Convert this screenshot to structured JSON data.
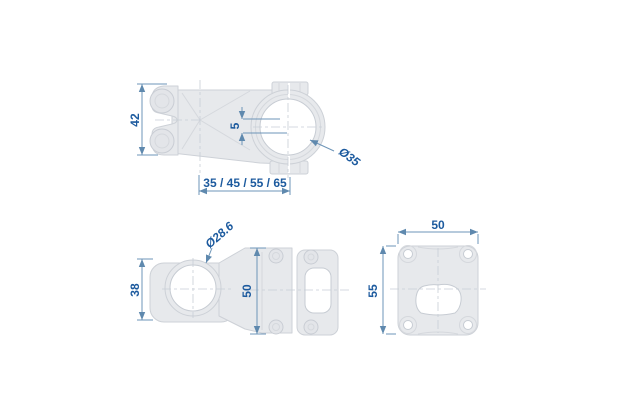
{
  "drawing": {
    "title": "stem-technical-drawing",
    "background": "#ffffff",
    "colors": {
      "part_fill": "#e7e9ec",
      "part_outline": "#cdd1d7",
      "detail_line": "#d5d8dd",
      "centerline": "#c8ced6",
      "dimension_line": "#6e95b8",
      "dimension_text": "#1c5a9e",
      "hole_fill": "#ffffff"
    },
    "views": {
      "top": {
        "label": "top view",
        "dims": {
          "height": "42",
          "rise": "5",
          "bar_clamp_diameter": "Ø35",
          "length_options": "35 / 45 / 55 / 65"
        }
      },
      "side": {
        "label": "side view",
        "dims": {
          "steerer_diameter": "Ø28.6",
          "clamp_height": "38",
          "front_height": "50"
        }
      },
      "front": {
        "label": "front view",
        "dims": {
          "width": "50",
          "height": "55"
        }
      }
    }
  }
}
